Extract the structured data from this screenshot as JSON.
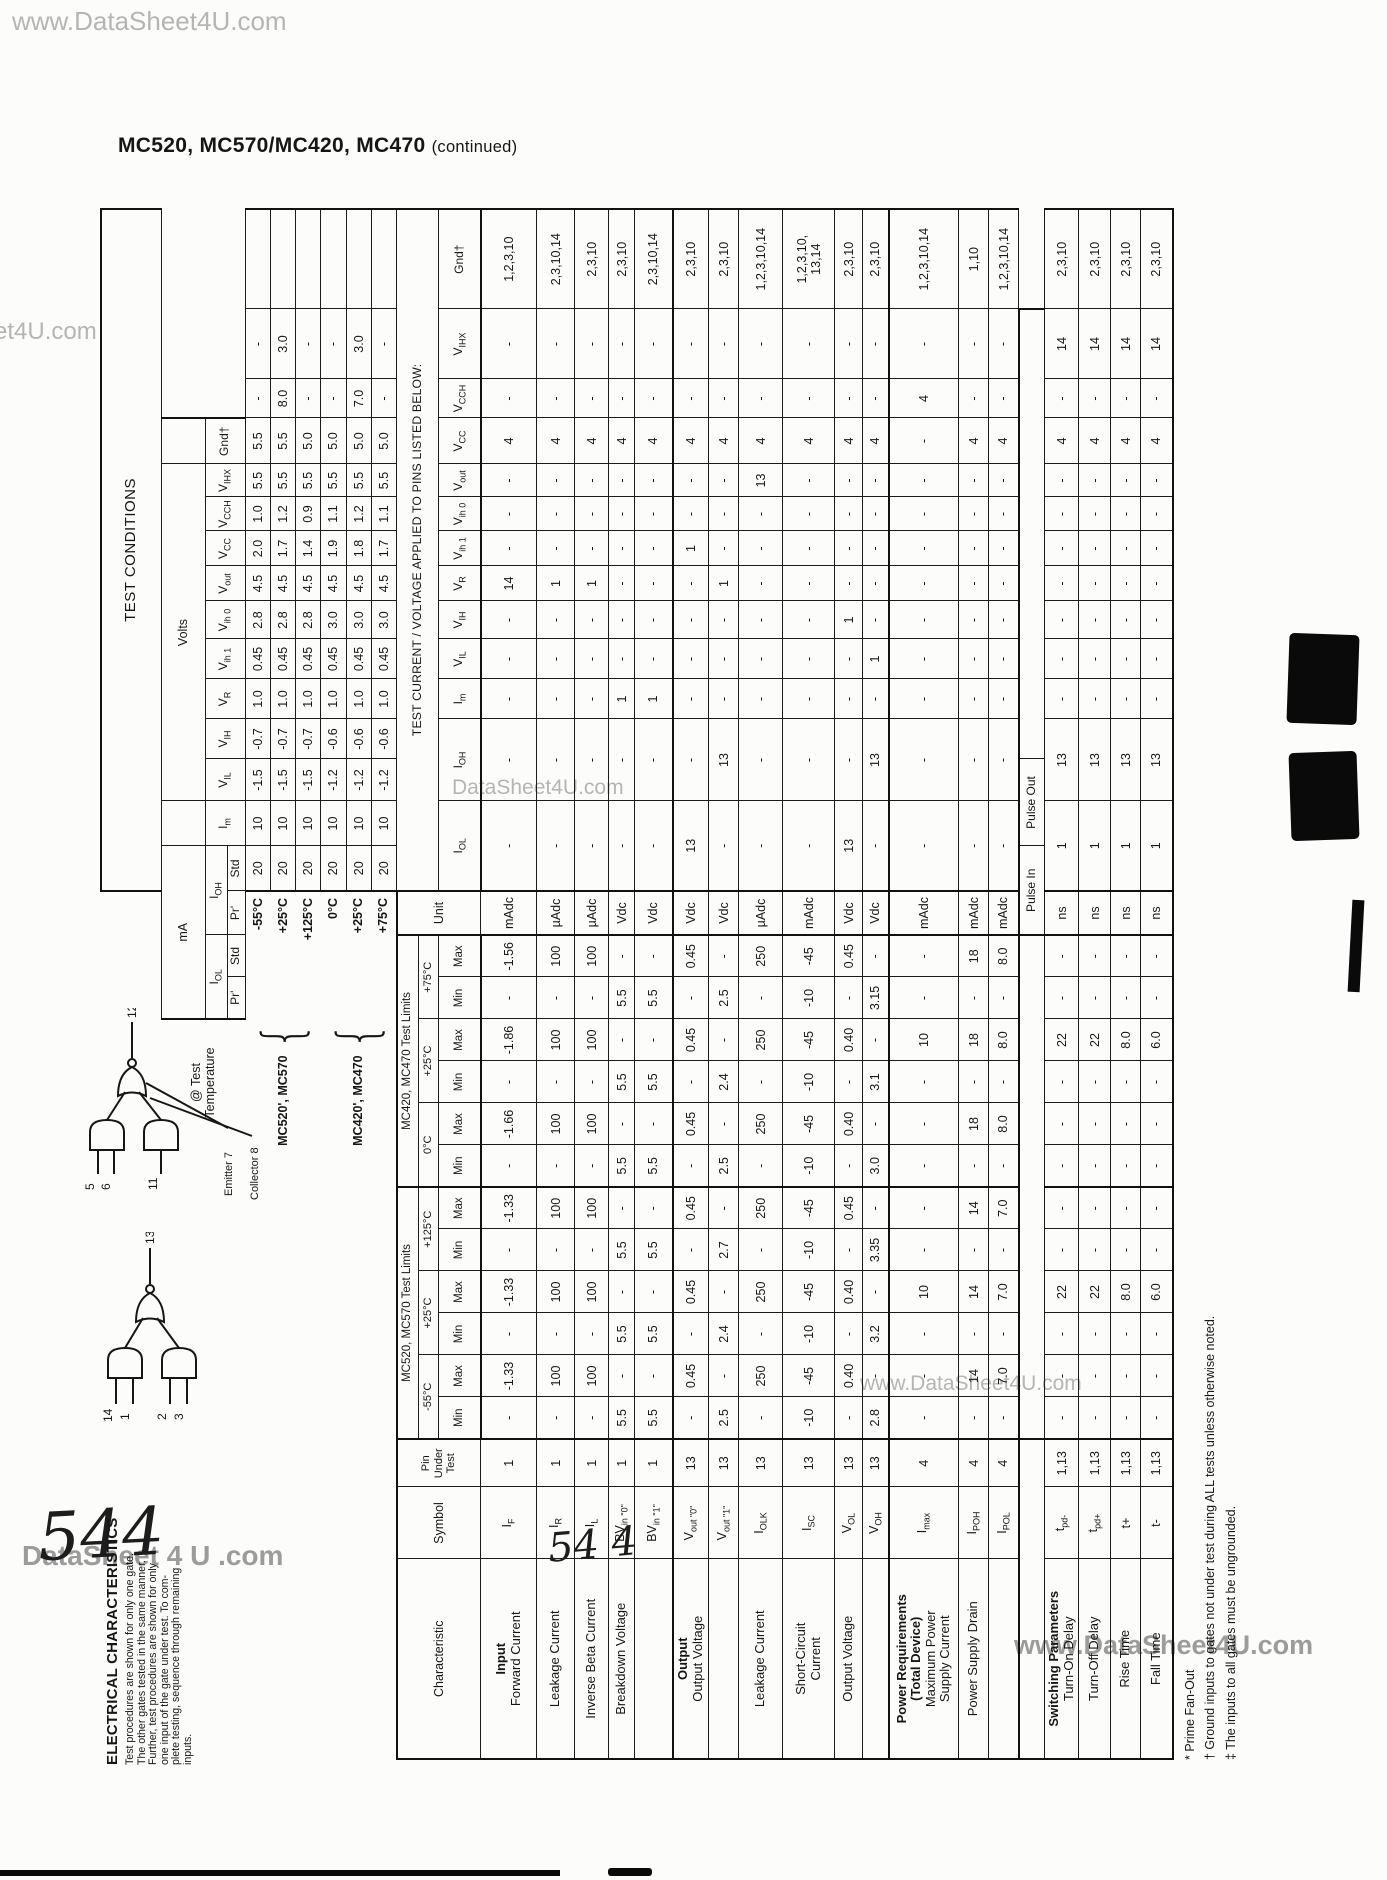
{
  "page": {
    "title_main": "MC520, MC570/MC420, MC470",
    "title_cont": "(continued)",
    "watermarks": {
      "top": "www.DataSheet4U.com",
      "left_edge": "et4U.com",
      "mid_table": "DataSheet4U.com",
      "lower_mid": "www.DataSheet4U.com",
      "footer_right": "www.DataSheet4U.com",
      "bottom_left": "DataSheet 4 U .com"
    },
    "handwritten_left": "544",
    "handwritten_center": "54 4"
  },
  "intro": {
    "heading": "ELECTRICAL CHARACTERISTICS",
    "lines": [
      "Test procedures are shown for only one gate.",
      "The other gates tested in the same manner.",
      "Further, test procedures are shown for only",
      "one input of the gate under test.  To com-",
      "plete testing, sequence through remaining",
      "inputs."
    ]
  },
  "diagrams": {
    "gate1": {
      "output_pin": "13",
      "input_pins": [
        "14",
        "1",
        "2",
        "3"
      ]
    },
    "gate2": {
      "output_pin": "12",
      "input_pins": [
        "5",
        "6",
        "11"
      ],
      "emitter_label": "Emitter 7",
      "collector_label": "Collector 8"
    }
  },
  "table": {
    "conditions_title": "TEST CONDITIONS",
    "ma_label": "mA",
    "volts_label": "Volts",
    "applied_note": "TEST CURRENT / VOLTAGE APPLIED TO PINS LISTED BELOW:",
    "at_test_label": "@ Test\nTemperature",
    "prime_label": "Pr'",
    "std_label": "Std",
    "cond_labels": [
      "I<sub>OL</sub>",
      "I<sub>OH</sub>",
      "I<sub>m</sub>",
      "V<sub>IL</sub>",
      "V<sub>IH</sub>",
      "V<sub>R</sub>",
      "V<sub>ih 1</sub>",
      "V<sub>ih 0</sub>",
      "V<sub>out</sub>",
      "V<sub>CC</sub>",
      "V<sub>CCH</sub>",
      "V<sub>IHX</sub>",
      "Gnd†"
    ],
    "left_headers": {
      "characteristic": "Characteristic",
      "symbol": "Symbol",
      "pin": "Pin\nUnder\nTest",
      "unit": "Unit"
    },
    "minmax": [
      "Min",
      "Max"
    ],
    "sections": [
      {
        "name": "MC520, MC570 Test Limits",
        "temps": [
          "-55°C",
          "+25°C",
          "+125°C"
        ]
      },
      {
        "name": "MC420, MC470 Test Limits",
        "temps": [
          "0°C",
          "+25°C",
          "+75°C"
        ]
      }
    ],
    "atest_groups": [
      {
        "name": "MC520', MC570",
        "temps": [
          "-55°C",
          "+25°C",
          "+125°C"
        ]
      },
      {
        "name": "MC420', MC470",
        "temps": [
          "0°C",
          "+25°C",
          "+75°C"
        ]
      }
    ],
    "temp_rows": [
      {
        "temp": "-55°C",
        "values": [
          "20",
          "10",
          "-1.5",
          "-0.7",
          "1.0",
          "0.45",
          "2.8",
          "4.5",
          "2.0",
          "1.0",
          "5.5",
          "5.5",
          "-",
          "-",
          ""
        ]
      },
      {
        "temp": "+25°C",
        "values": [
          "20",
          "10",
          "-1.5",
          "-0.7",
          "1.0",
          "0.45",
          "2.8",
          "4.5",
          "1.7",
          "1.2",
          "5.5",
          "5.5",
          "8.0",
          "3.0",
          ""
        ]
      },
      {
        "temp": "+125°C",
        "values": [
          "20",
          "10",
          "-1.5",
          "-0.7",
          "1.0",
          "0.45",
          "2.8",
          "4.5",
          "1.4",
          "0.9",
          "5.5",
          "5.0",
          "-",
          "-",
          ""
        ]
      },
      {
        "temp": "0°C",
        "values": [
          "20",
          "10",
          "-1.2",
          "-0.6",
          "1.0",
          "0.45",
          "3.0",
          "4.5",
          "1.9",
          "1.1",
          "5.5",
          "5.0",
          "-",
          "-",
          ""
        ]
      },
      {
        "temp": "+25°C",
        "values": [
          "20",
          "10",
          "-1.2",
          "-0.6",
          "1.0",
          "0.45",
          "3.0",
          "4.5",
          "1.8",
          "1.2",
          "5.5",
          "5.0",
          "7.0",
          "3.0",
          ""
        ]
      },
      {
        "temp": "+75°C",
        "values": [
          "20",
          "10",
          "-1.2",
          "-0.6",
          "1.0",
          "0.45",
          "3.0",
          "4.5",
          "1.7",
          "1.1",
          "5.5",
          "5.0",
          "-",
          "-",
          ""
        ]
      }
    ],
    "pulse_labels": [
      "Pulse In",
      "Pulse Out"
    ],
    "rows": [
      {
        "group": "Input",
        "name": "Forward Current",
        "symbol": "I<sub>F</sub>",
        "pin": "1",
        "h": 56,
        "limits": [
          "-",
          "-1.33",
          "-",
          "-1.33",
          "-",
          "-1.33",
          "-",
          "-1.66",
          "-",
          "-1.86",
          "-",
          "-1.56"
        ],
        "unit": "mAdc",
        "cond": [
          "-",
          "-",
          "-",
          "-",
          "-",
          "14",
          "-",
          "-",
          "-",
          "4",
          "-",
          "-",
          "1,2,3,10"
        ]
      },
      {
        "name": "Leakage Current",
        "symbol": "I<sub>R</sub>",
        "pin": "1",
        "h": 38,
        "limits": [
          "-",
          "100",
          "-",
          "100",
          "-",
          "100",
          "-",
          "100",
          "-",
          "100",
          "-",
          "100"
        ],
        "unit": "µAdc",
        "cond": [
          "-",
          "-",
          "-",
          "-",
          "-",
          "1",
          "-",
          "-",
          "-",
          "4",
          "-",
          "-",
          "2,3,10,14"
        ]
      },
      {
        "name": "Inverse Beta Current",
        "symbol": "I<sub>L</sub>",
        "pin": "1",
        "h": 34,
        "limits": [
          "-",
          "100",
          "-",
          "100",
          "-",
          "100",
          "-",
          "100",
          "-",
          "100",
          "-",
          "100"
        ],
        "unit": "µAdc",
        "cond": [
          "-",
          "-",
          "-",
          "-",
          "-",
          "1",
          "-",
          "-",
          "-",
          "4",
          "-",
          "-",
          "2,3,10"
        ]
      },
      {
        "name": "Breakdown Voltage",
        "symbol": "BV<sub>in \"0\"</sub>",
        "pin": "1",
        "h": 26,
        "limits": [
          "5.5",
          "-",
          "5.5",
          "-",
          "5.5",
          "-",
          "5.5",
          "-",
          "5.5",
          "-",
          "5.5",
          "-"
        ],
        "unit": "Vdc",
        "cond": [
          "-",
          "-",
          "1",
          "-",
          "-",
          "-",
          "-",
          "-",
          "-",
          "4",
          "-",
          "-",
          "2,3,10"
        ]
      },
      {
        "name": "",
        "symbol": "BV<sub>in \"1\"</sub>",
        "pin": "1",
        "h": 38,
        "limits": [
          "5.5",
          "-",
          "5.5",
          "-",
          "5.5",
          "-",
          "5.5",
          "-",
          "5.5",
          "-",
          "5.5",
          "-"
        ],
        "unit": "Vdc",
        "cond": [
          "-",
          "-",
          "1",
          "-",
          "-",
          "-",
          "-",
          "-",
          "-",
          "4",
          "-",
          "-",
          "2,3,10,14"
        ]
      },
      {
        "group": "Output",
        "name": "Output Voltage",
        "symbol": "V<sub>out \"0\"</sub>",
        "pin": "13",
        "h": 36,
        "sec": true,
        "limits": [
          "-",
          "0.45",
          "-",
          "0.45",
          "-",
          "0.45",
          "-",
          "0.45",
          "-",
          "0.45",
          "-",
          "0.45"
        ],
        "unit": "Vdc",
        "cond": [
          "13",
          "-",
          "-",
          "-",
          "-",
          "-",
          "1",
          "-",
          "-",
          "4",
          "-",
          "-",
          "2,3,10"
        ]
      },
      {
        "name": "",
        "symbol": "V<sub>out \"1\"</sub>",
        "pin": "13",
        "h": 30,
        "limits": [
          "2.5",
          "-",
          "2.4",
          "-",
          "2.7",
          "-",
          "2.5",
          "-",
          "2.4",
          "-",
          "2.5",
          "-"
        ],
        "unit": "Vdc",
        "cond": [
          "-",
          "13",
          "-",
          "-",
          "-",
          "1",
          "-",
          "-",
          "-",
          "4",
          "-",
          "-",
          "2,3,10"
        ]
      },
      {
        "name": "Leakage Current",
        "symbol": "I<sub>OLK</sub>",
        "pin": "13",
        "h": 44,
        "limits": [
          "-",
          "250",
          "-",
          "250",
          "-",
          "250",
          "-",
          "250",
          "-",
          "250",
          "-",
          "250"
        ],
        "unit": "µAdc",
        "cond": [
          "-",
          "-",
          "-",
          "-",
          "-",
          "-",
          "-",
          "-",
          "13",
          "4",
          "-",
          "-",
          "1,2,3,10,14"
        ]
      },
      {
        "name": "Short-Circuit\nCurrent",
        "symbol": "I<sub>SC</sub>",
        "pin": "13",
        "h": 52,
        "limits": [
          "-10",
          "-45",
          "-10",
          "-45",
          "-10",
          "-45",
          "-10",
          "-45",
          "-10",
          "-45",
          "-10",
          "-45"
        ],
        "unit": "mAdc",
        "cond": [
          "-",
          "-",
          "-",
          "-",
          "-",
          "-",
          "-",
          "-",
          "-",
          "4",
          "-",
          "-",
          "1,2,3,10,\n13,14"
        ]
      },
      {
        "name": "Output Voltage",
        "symbol": "V<sub>OL</sub>",
        "pin": "13",
        "h": 28,
        "limits": [
          "-",
          "0.40",
          "-",
          "0.40",
          "-",
          "0.45",
          "-",
          "0.40",
          "-",
          "0.40",
          "-",
          "0.45"
        ],
        "unit": "Vdc",
        "cond": [
          "13",
          "-",
          "-",
          "-",
          "1",
          "-",
          "-",
          "-",
          "-",
          "4",
          "-",
          "-",
          "2,3,10"
        ]
      },
      {
        "name": "",
        "symbol": "V<sub>OH</sub>",
        "pin": "13",
        "h": 26,
        "limits": [
          "2.8",
          "-",
          "3.2",
          "-",
          "3.35",
          "-",
          "3.0",
          "-",
          "3.1",
          "-",
          "3.15",
          "-"
        ],
        "unit": "Vdc",
        "cond": [
          "-",
          "13",
          "-",
          "1",
          "-",
          "-",
          "-",
          "-",
          "-",
          "4",
          "-",
          "-",
          "2,3,10"
        ]
      },
      {
        "group": "Power Requirements\n(Total Device)",
        "name": "Maximum Power\nSupply Current",
        "symbol": "I<sub>max</sub>",
        "pin": "4",
        "h": 70,
        "sec": true,
        "limits": [
          "-",
          "-",
          "-",
          "10",
          "-",
          "-",
          "-",
          "-",
          "-",
          "10",
          "-",
          "-"
        ],
        "unit": "mAdc",
        "cond": [
          "-",
          "-",
          "-",
          "-",
          "-",
          "-",
          "-",
          "-",
          "-",
          "-",
          "4",
          "-",
          "1,2,3,10,14"
        ]
      },
      {
        "name": "Power Supply Drain",
        "symbol": "I<sub>POH</sub>",
        "pin": "4",
        "h": 30,
        "limits": [
          "-",
          "14",
          "-",
          "14",
          "-",
          "14",
          "-",
          "18",
          "-",
          "18",
          "-",
          "18"
        ],
        "unit": "mAdc",
        "cond": [
          "-",
          "-",
          "-",
          "-",
          "-",
          "-",
          "-",
          "-",
          "-",
          "4",
          "-",
          "-",
          "1,10"
        ]
      },
      {
        "name": "",
        "symbol": "I<sub>POL</sub>",
        "pin": "4",
        "h": 30,
        "limits": [
          "-",
          "7.0",
          "-",
          "7.0",
          "-",
          "7.0",
          "-",
          "8.0",
          "-",
          "8.0",
          "-",
          "8.0"
        ],
        "unit": "mAdc",
        "cond": [
          "-",
          "-",
          "-",
          "-",
          "-",
          "-",
          "-",
          "-",
          "-",
          "4",
          "-",
          "-",
          "1,2,3,10,14"
        ]
      },
      {
        "pulse": true,
        "h": 26
      },
      {
        "group": "Switching Parameters",
        "name": "Turn-On Delay",
        "symbol": "t<sub>pd-</sub>",
        "pin": "1,13",
        "h": 34,
        "limits": [
          "-",
          "-",
          "-",
          "22",
          "-",
          "-",
          "-",
          "-",
          "-",
          "22",
          "-",
          "-"
        ],
        "unit": "ns",
        "cond": [
          "1",
          "13",
          "-",
          "-",
          "-",
          "-",
          "-",
          "-",
          "-",
          "4",
          "-",
          "14",
          "2,3,10"
        ]
      },
      {
        "name": "Turn-Off Delay",
        "symbol": "t<sub>pd+</sub>",
        "pin": "1,13",
        "h": 32,
        "limits": [
          "-",
          "-",
          "-",
          "22",
          "-",
          "-",
          "-",
          "-",
          "-",
          "22",
          "-",
          "-"
        ],
        "unit": "ns",
        "cond": [
          "1",
          "13",
          "-",
          "-",
          "-",
          "-",
          "-",
          "-",
          "-",
          "4",
          "-",
          "14",
          "2,3,10"
        ]
      },
      {
        "name": "Rise Time",
        "symbol": "t+",
        "pin": "1,13",
        "h": 30,
        "limits": [
          "-",
          "-",
          "-",
          "8.0",
          "-",
          "-",
          "-",
          "-",
          "-",
          "8.0",
          "-",
          "-"
        ],
        "unit": "ns",
        "cond": [
          "1",
          "13",
          "-",
          "-",
          "-",
          "-",
          "-",
          "-",
          "-",
          "4",
          "-",
          "14",
          "2,3,10"
        ]
      },
      {
        "name": "Fall Time",
        "symbol": "t-",
        "pin": "1,13",
        "h": 32,
        "limits": [
          "-",
          "-",
          "-",
          "6.0",
          "-",
          "-",
          "-",
          "-",
          "-",
          "6.0",
          "-",
          "-"
        ],
        "unit": "ns",
        "cond": [
          "1",
          "13",
          "-",
          "-",
          "-",
          "-",
          "-",
          "-",
          "-",
          "4",
          "-",
          "14",
          "2,3,10"
        ]
      }
    ]
  },
  "footnotes": [
    "* Prime Fan-Out",
    "† Ground inputs to gates not under test during ALL tests unless otherwise noted.",
    "‡ The inputs to all gates must be ungrounded."
  ]
}
